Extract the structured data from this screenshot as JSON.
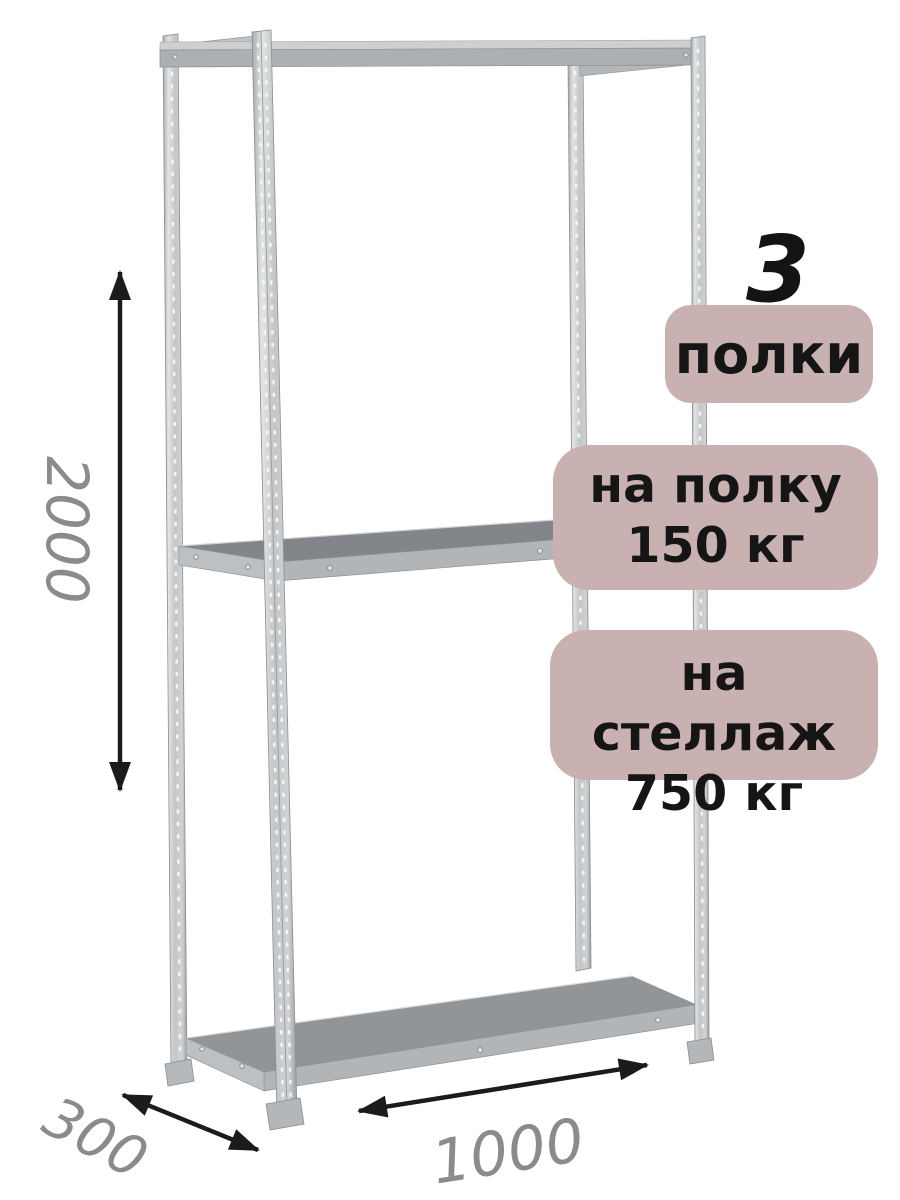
{
  "product": {
    "kind": "metal-shelving-rack-diagram",
    "shelves": {
      "count": "3",
      "count_label": "полки"
    },
    "load": {
      "per_shelf": {
        "line1": "на полку",
        "line2": "150 кг"
      },
      "per_rack": {
        "line1": "на стеллаж",
        "line2": "750 кг"
      }
    },
    "dimensions_mm": {
      "height": "2000",
      "depth": "300",
      "width": "1000"
    }
  },
  "colors": {
    "badge_background": "#c9b1b1",
    "badge_text": "#151515",
    "dimension_text": "#8b8b8b",
    "arrow": "#1b1b1b",
    "metal_light": "#c6c9cb",
    "metal_medium": "#b2b5b8",
    "shelf_top_middle": "#82868a",
    "shelf_top_bottom": "#929598",
    "background": "#ffffff"
  }
}
